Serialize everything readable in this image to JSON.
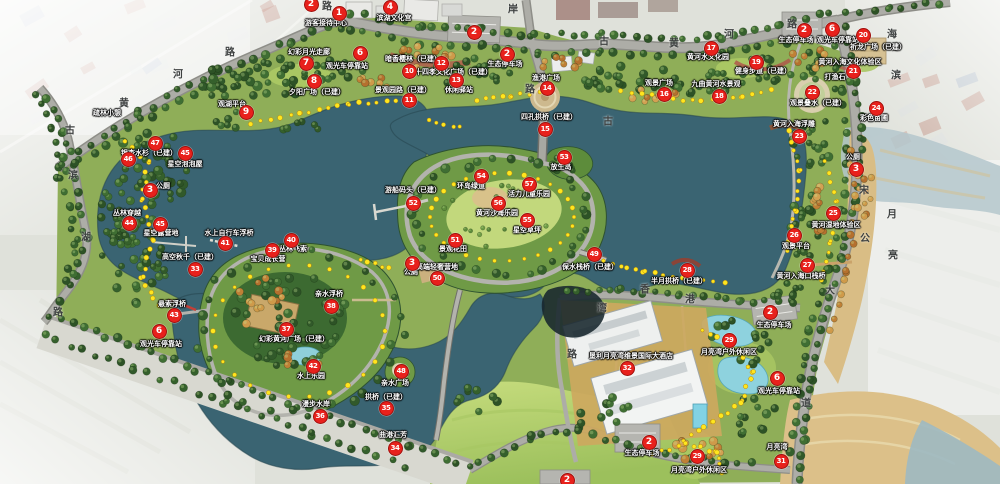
{
  "map": {
    "name": "lake-park-master-plan",
    "colors": {
      "marker_red": "#e8211c",
      "water": "#3a6472",
      "water_pale": "#b4c7cc",
      "park_green": "#8fae58",
      "lawn_green": "#b9d46f",
      "forest_green": "#35602c",
      "sand": "#d9bd85",
      "road_gray": "#a7a7a1",
      "label_text": "#ffffff",
      "path_dot_yellow": "#ffe61e"
    },
    "road_labels": [
      {
        "text": "黄",
        "x": 124,
        "y": 102
      },
      {
        "text": "河",
        "x": 178,
        "y": 73
      },
      {
        "text": "路",
        "x": 230,
        "y": 51
      },
      {
        "text": "路",
        "x": 327,
        "y": 5
      },
      {
        "text": "古",
        "x": 70,
        "y": 129
      },
      {
        "text": "滨",
        "x": 73,
        "y": 174
      },
      {
        "text": "湖",
        "x": 86,
        "y": 236
      },
      {
        "text": "路",
        "x": 58,
        "y": 311
      },
      {
        "text": "岸",
        "x": 513,
        "y": 8
      },
      {
        "text": "路",
        "x": 530,
        "y": 88
      },
      {
        "text": "古",
        "x": 604,
        "y": 40
      },
      {
        "text": "古",
        "x": 608,
        "y": 120
      },
      {
        "text": "黄",
        "x": 674,
        "y": 42
      },
      {
        "text": "河",
        "x": 729,
        "y": 33
      },
      {
        "text": "路",
        "x": 792,
        "y": 23
      },
      {
        "text": "海",
        "x": 892,
        "y": 33
      },
      {
        "text": "滨",
        "x": 896,
        "y": 74
      },
      {
        "text": "宋",
        "x": 864,
        "y": 189
      },
      {
        "text": "公",
        "x": 865,
        "y": 237
      },
      {
        "text": "月",
        "x": 892,
        "y": 213
      },
      {
        "text": "亮",
        "x": 893,
        "y": 254
      },
      {
        "text": "大",
        "x": 830,
        "y": 289
      },
      {
        "text": "道",
        "x": 806,
        "y": 402
      },
      {
        "text": "香",
        "x": 645,
        "y": 288
      },
      {
        "text": "港",
        "x": 690,
        "y": 298
      },
      {
        "text": "湾",
        "x": 602,
        "y": 307
      },
      {
        "text": "路",
        "x": 572,
        "y": 353
      }
    ],
    "extra_labels": [
      {
        "text": "打渔石",
        "x": 835,
        "y": 77
      }
    ],
    "markers": [
      {
        "num": "2",
        "x": 310,
        "y": 3,
        "label": ""
      },
      {
        "num": "1",
        "x": 338,
        "y": 12,
        "label": "游客接待中心",
        "lx": 326,
        "ly": 23
      },
      {
        "num": "4",
        "x": 389,
        "y": 6,
        "label": "滨湖文化宫",
        "lx": 394,
        "ly": 18
      },
      {
        "num": "2",
        "x": 473,
        "y": 31,
        "label": ""
      },
      {
        "num": "2",
        "x": 506,
        "y": 53,
        "label": "生态停车场",
        "lx": 505,
        "ly": 64
      },
      {
        "num": "6",
        "x": 359,
        "y": 52,
        "label": "观光车停靠站",
        "lx": 347,
        "ly": 66
      },
      {
        "num": "7",
        "x": 305,
        "y": 62,
        "label": "幻彩月光走廊",
        "lx": 309,
        "ly": 52
      },
      {
        "num": "8",
        "x": 313,
        "y": 80,
        "label": "夕阳广场（已建）",
        "lx": 317,
        "ly": 92
      },
      {
        "num": "9",
        "x": 245,
        "y": 111,
        "label": "观湖平台",
        "lx": 232,
        "ly": 104
      },
      {
        "num": "10",
        "x": 408,
        "y": 70,
        "label": "二十四孝文化广场（已建）",
        "lx": 450,
        "ly": 72
      },
      {
        "num": "12",
        "x": 440,
        "y": 62,
        "label": "暗香樱林（已建）",
        "lx": 413,
        "ly": 59
      },
      {
        "num": "13",
        "x": 455,
        "y": 79,
        "label": "休闲驿站",
        "lx": 459,
        "ly": 90
      },
      {
        "num": "11",
        "x": 408,
        "y": 99,
        "label": "景观园路（已建）",
        "lx": 403,
        "ly": 90
      },
      {
        "num": "14",
        "x": 546,
        "y": 87,
        "label": "渔港广场",
        "lx": 546,
        "ly": 78
      },
      {
        "num": "15",
        "x": 544,
        "y": 128,
        "label": "四孔拱桥（已建）",
        "lx": 549,
        "ly": 117
      },
      {
        "num": "16",
        "x": 663,
        "y": 93,
        "label": "观景广场",
        "lx": 659,
        "ly": 83
      },
      {
        "num": "17",
        "x": 710,
        "y": 47,
        "label": "黄河水文化园",
        "lx": 708,
        "ly": 57
      },
      {
        "num": "18",
        "x": 718,
        "y": 95,
        "label": "九曲黄河水景观",
        "lx": 716,
        "ly": 84
      },
      {
        "num": "19",
        "x": 755,
        "y": 61,
        "label": "健身步道（已建）",
        "lx": 763,
        "ly": 71
      },
      {
        "num": "2",
        "x": 803,
        "y": 29,
        "label": "生态停车场",
        "lx": 796,
        "ly": 40
      },
      {
        "num": "6",
        "x": 831,
        "y": 28,
        "label": "观光车停靠站",
        "lx": 838,
        "ly": 40
      },
      {
        "num": "20",
        "x": 862,
        "y": 34,
        "label": "祈龙广场（已建）",
        "lx": 878,
        "ly": 47
      },
      {
        "num": "21",
        "x": 852,
        "y": 70,
        "label": "黄河入海文化体验区",
        "lx": 850,
        "ly": 62
      },
      {
        "num": "22",
        "x": 811,
        "y": 91,
        "label": "观景叠水（已建）",
        "lx": 818,
        "ly": 103
      },
      {
        "num": "24",
        "x": 875,
        "y": 107,
        "label": "彩色苗圃",
        "lx": 874,
        "ly": 118
      },
      {
        "num": "23",
        "x": 798,
        "y": 135,
        "label": "黄河入海浮雕",
        "lx": 794,
        "ly": 124
      },
      {
        "num": "3",
        "x": 855,
        "y": 168,
        "label": "公厕",
        "lx": 853,
        "ly": 157
      },
      {
        "num": "25",
        "x": 832,
        "y": 212,
        "label": "黄河湿地体验区",
        "lx": 836,
        "ly": 225
      },
      {
        "num": "26",
        "x": 793,
        "y": 234,
        "label": "观景平台",
        "lx": 796,
        "ly": 246
      },
      {
        "num": "27",
        "x": 806,
        "y": 264,
        "label": "黄河入海口栈桥",
        "lx": 801,
        "ly": 276
      },
      {
        "num": "28",
        "x": 686,
        "y": 269,
        "label": "半月拱桥（已建）",
        "lx": 679,
        "ly": 281
      },
      {
        "num": "2",
        "x": 769,
        "y": 311,
        "label": "生态停车场",
        "lx": 774,
        "ly": 325
      },
      {
        "num": "29",
        "x": 728,
        "y": 339,
        "label": "月亮湾户外休闲区",
        "lx": 729,
        "ly": 352
      },
      {
        "num": "6",
        "x": 776,
        "y": 377,
        "label": "观光车停靠站",
        "lx": 779,
        "ly": 391
      },
      {
        "num": "32",
        "x": 626,
        "y": 367,
        "label": "垦利月亮湾维景国际大酒店",
        "lx": 631,
        "ly": 356
      },
      {
        "num": "2",
        "x": 648,
        "y": 441,
        "label": "生态停车场",
        "lx": 642,
        "ly": 453
      },
      {
        "num": "29",
        "x": 696,
        "y": 455,
        "label": "月亮湾户外休闲区",
        "lx": 699,
        "ly": 470
      },
      {
        "num": "31",
        "x": 780,
        "y": 460,
        "label": "月亮湾",
        "lx": 777,
        "ly": 447
      },
      {
        "num": "2",
        "x": 566,
        "y": 479,
        "label": ""
      },
      {
        "num": "47",
        "x": 154,
        "y": 142,
        "label": "银杏水杉（已建）",
        "lx": 149,
        "ly": 153
      },
      {
        "num": "46",
        "x": 127,
        "y": 158,
        "label": "疏林小憩",
        "lx": 107,
        "ly": 113
      },
      {
        "num": "45",
        "x": 184,
        "y": 152,
        "label": "星空泡泡屋",
        "lx": 185,
        "ly": 164
      },
      {
        "num": "3",
        "x": 149,
        "y": 189,
        "label": "公厕",
        "lx": 163,
        "ly": 186
      },
      {
        "num": "44",
        "x": 128,
        "y": 222,
        "label": "丛林穿越",
        "lx": 127,
        "ly": 213
      },
      {
        "num": "45",
        "x": 159,
        "y": 223,
        "label": "星空露营地",
        "lx": 161,
        "ly": 233
      },
      {
        "num": "41",
        "x": 224,
        "y": 242,
        "label": "水上自行车浮桥",
        "lx": 229,
        "ly": 233
      },
      {
        "num": "40",
        "x": 290,
        "y": 239,
        "label": "丛林飞索",
        "lx": 293,
        "ly": 249
      },
      {
        "num": "39",
        "x": 271,
        "y": 249,
        "label": "宝贝成长营",
        "lx": 268,
        "ly": 259
      },
      {
        "num": "33",
        "x": 194,
        "y": 268,
        "label": "高空秋千（已建）",
        "lx": 190,
        "ly": 257
      },
      {
        "num": "43",
        "x": 173,
        "y": 314,
        "label": "悬索浮桥",
        "lx": 172,
        "ly": 304
      },
      {
        "num": "38",
        "x": 330,
        "y": 305,
        "label": "亲水浮桥",
        "lx": 329,
        "ly": 294
      },
      {
        "num": "37",
        "x": 285,
        "y": 328,
        "label": "幻彩黄河广场（已建）",
        "lx": 294,
        "ly": 339
      },
      {
        "num": "6",
        "x": 158,
        "y": 330,
        "label": "观光车停靠站",
        "lx": 161,
        "ly": 344
      },
      {
        "num": "42",
        "x": 312,
        "y": 365,
        "label": "水上乐园",
        "lx": 311,
        "ly": 376
      },
      {
        "num": "48",
        "x": 400,
        "y": 370,
        "label": "亲水广场",
        "lx": 395,
        "ly": 383
      },
      {
        "num": "35",
        "x": 385,
        "y": 407,
        "label": "拱桥（已建）",
        "lx": 386,
        "ly": 397
      },
      {
        "num": "36",
        "x": 319,
        "y": 415,
        "label": "漫步水岸",
        "lx": 316,
        "ly": 404
      },
      {
        "num": "34",
        "x": 394,
        "y": 447,
        "label": "曲港汇芳",
        "lx": 393,
        "ly": 435
      },
      {
        "num": "52",
        "x": 412,
        "y": 202,
        "label": "游船码头（已建）",
        "lx": 413,
        "ly": 190
      },
      {
        "num": "54",
        "x": 480,
        "y": 175,
        "label": "环岛绿道",
        "lx": 471,
        "ly": 186
      },
      {
        "num": "53",
        "x": 563,
        "y": 156,
        "label": "放生岛",
        "lx": 561,
        "ly": 167
      },
      {
        "num": "57",
        "x": 528,
        "y": 183,
        "label": "活力儿童乐园",
        "lx": 529,
        "ly": 194
      },
      {
        "num": "56",
        "x": 497,
        "y": 202,
        "label": "黄河沙海乐园",
        "lx": 497,
        "ly": 213
      },
      {
        "num": "55",
        "x": 526,
        "y": 219,
        "label": "星空草坪",
        "lx": 527,
        "ly": 230
      },
      {
        "num": "51",
        "x": 454,
        "y": 239,
        "label": "景观花田",
        "lx": 453,
        "ly": 249
      },
      {
        "num": "3",
        "x": 411,
        "y": 262,
        "label": "公厕",
        "lx": 411,
        "ly": 272
      },
      {
        "num": "50",
        "x": 436,
        "y": 277,
        "label": "高端轻奢营地",
        "lx": 437,
        "ly": 267
      },
      {
        "num": "49",
        "x": 593,
        "y": 253,
        "label": "保水栈桥（已建）",
        "lx": 590,
        "ly": 267
      }
    ]
  }
}
